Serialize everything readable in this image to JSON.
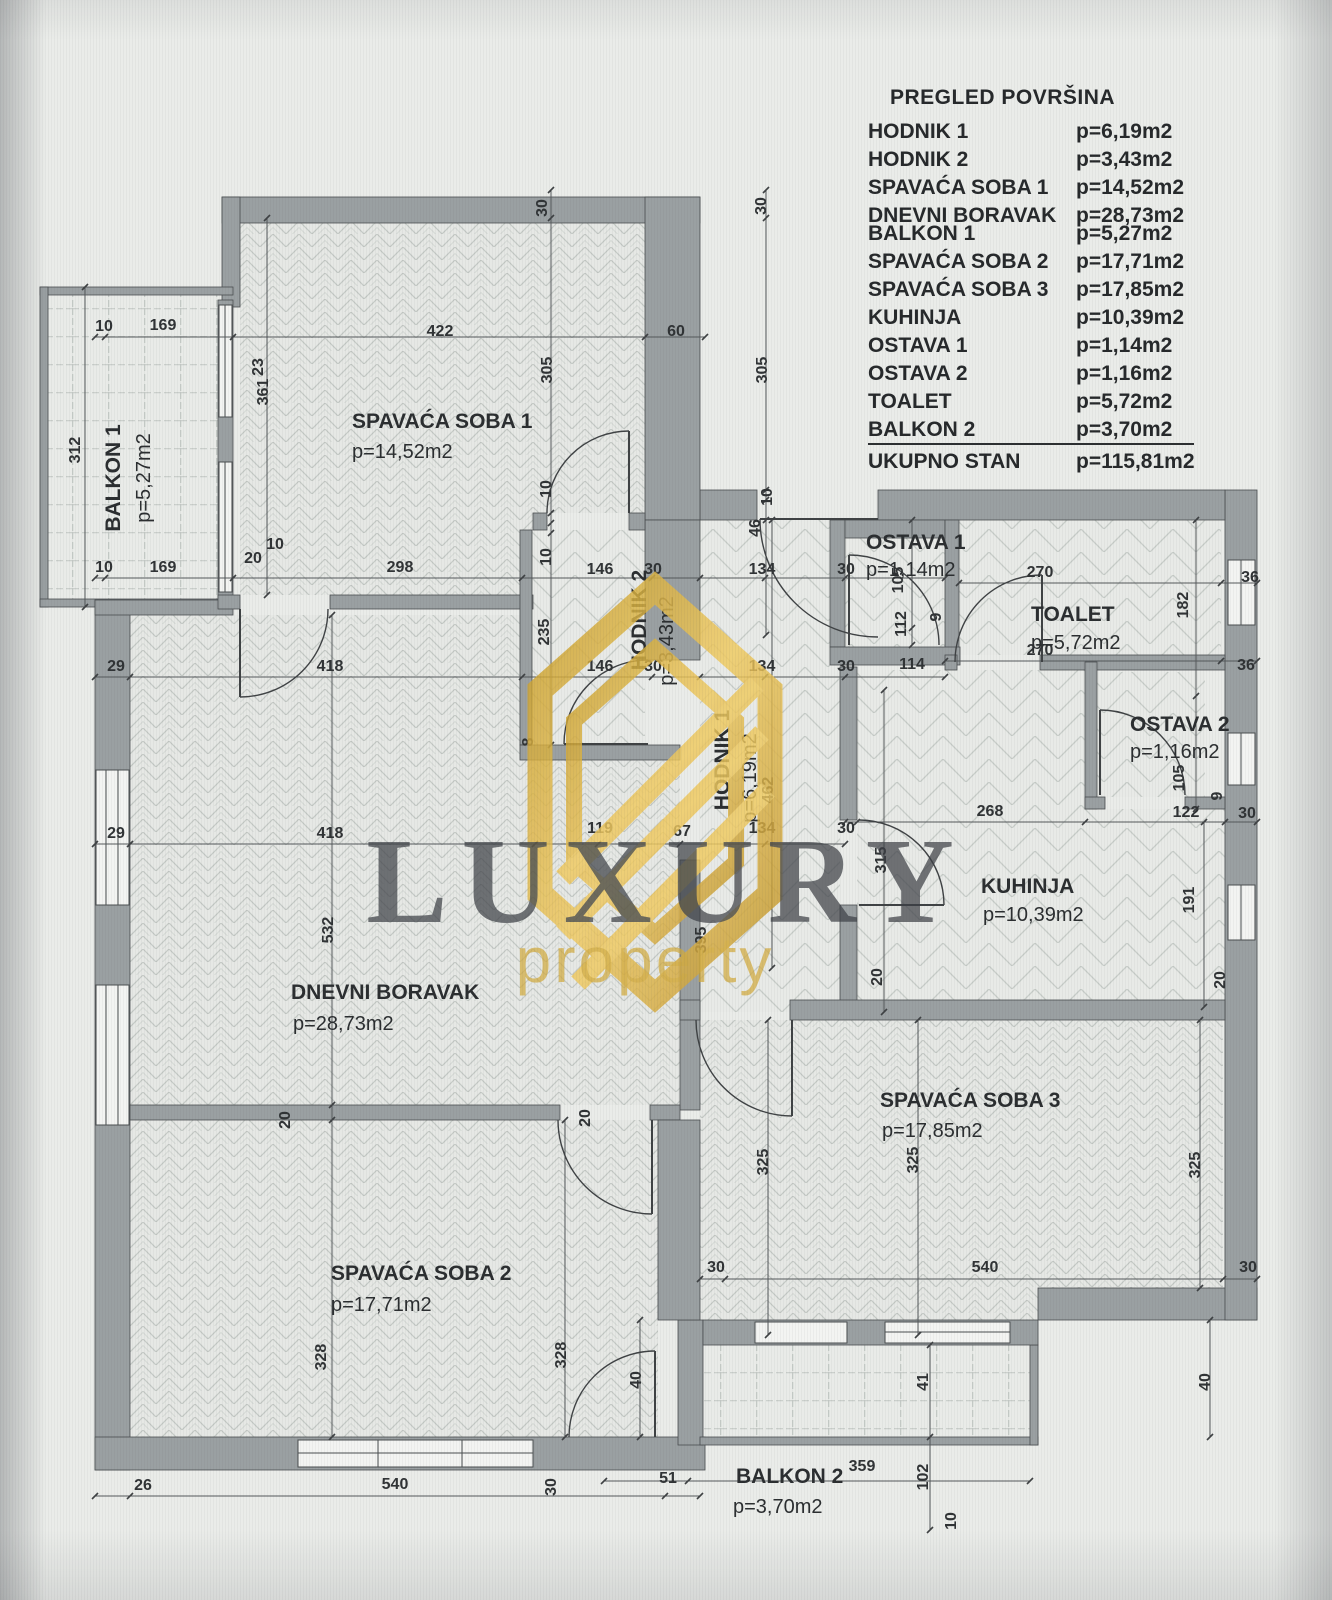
{
  "legend": {
    "title": "PREGLED POVRŠINA",
    "rows": [
      {
        "name": "HODNIK 1",
        "area": "p=6,19m2"
      },
      {
        "name": "HODNIK 2",
        "area": "p=3,43m2"
      },
      {
        "name": "SPAVAĆA SOBA 1",
        "area": "p=14,52m2"
      },
      {
        "name": "DNEVNI BORAVAK",
        "area": "p=28,73m2"
      },
      {
        "name": "BALKON 1",
        "area": "p=5,27m2",
        "tight": true
      },
      {
        "name": "SPAVAĆA SOBA 2",
        "area": "p=17,71m2"
      },
      {
        "name": "SPAVAĆA SOBA 3",
        "area": "p=17,85m2"
      },
      {
        "name": "KUHINJA",
        "area": "p=10,39m2"
      },
      {
        "name": "OSTAVA 1",
        "area": "p=1,14m2"
      },
      {
        "name": "OSTAVA 2",
        "area": "p=1,16m2"
      },
      {
        "name": "TOALET",
        "area": "p=5,72m2"
      },
      {
        "name": "BALKON 2",
        "area": "p=3,70m2",
        "underline": true
      },
      {
        "name": "UKUPNO STAN",
        "area": "p=115,81m2"
      }
    ]
  },
  "rooms": [
    {
      "name": "BALKON 1",
      "area": "p=5,27m2"
    },
    {
      "name": "SPAVAĆA SOBA 1",
      "area": "p=14,52m2"
    },
    {
      "name": "HODNIK 2",
      "area": "p=3,43m2"
    },
    {
      "name": "HODNIK 1",
      "area": "p=6,19m2"
    },
    {
      "name": "OSTAVA 1",
      "area": "p=1,14m2"
    },
    {
      "name": "TOALET",
      "area": "p=5,72m2"
    },
    {
      "name": "OSTAVA 2",
      "area": "p=1,16m2"
    },
    {
      "name": "KUHINJA",
      "area": "p=10,39m2"
    },
    {
      "name": "DNEVNI BORAVAK",
      "area": "p=28,73m2"
    },
    {
      "name": "SPAVAĆA SOBA 3",
      "area": "p=17,85m2"
    },
    {
      "name": "SPAVAĆA SOBA 2",
      "area": "p=17,71m2"
    },
    {
      "name": "BALKON 2",
      "area": "p=3,70m2"
    }
  ],
  "watermark": {
    "title": "LUXURY",
    "subtitle": "property"
  },
  "colors": {
    "wall": "#9aa0a2",
    "gold": "#dcae39",
    "ink": "#303335"
  },
  "dimensions": [
    {
      "v": "10",
      "x": 104,
      "y": 331
    },
    {
      "v": "169",
      "x": 163,
      "y": 330
    },
    {
      "v": "422",
      "x": 440,
      "y": 336
    },
    {
      "v": "60",
      "x": 676,
      "y": 336
    },
    {
      "v": "10",
      "x": 104,
      "y": 572
    },
    {
      "v": "169",
      "x": 163,
      "y": 572
    },
    {
      "v": "298",
      "x": 400,
      "y": 572
    },
    {
      "v": "146",
      "x": 600,
      "y": 574
    },
    {
      "v": "30",
      "x": 653,
      "y": 574
    },
    {
      "v": "134",
      "x": 762,
      "y": 574
    },
    {
      "v": "30",
      "x": 846,
      "y": 574
    },
    {
      "v": "270",
      "x": 1040,
      "y": 577
    },
    {
      "v": "36",
      "x": 1250,
      "y": 582
    },
    {
      "v": "29",
      "x": 116,
      "y": 671
    },
    {
      "v": "418",
      "x": 330,
      "y": 671
    },
    {
      "v": "146",
      "x": 600,
      "y": 671
    },
    {
      "v": "30",
      "x": 653,
      "y": 671
    },
    {
      "v": "134",
      "x": 762,
      "y": 671
    },
    {
      "v": "30",
      "x": 846,
      "y": 671
    },
    {
      "v": "114",
      "x": 912,
      "y": 669
    },
    {
      "v": "270",
      "x": 1040,
      "y": 655
    },
    {
      "v": "36",
      "x": 1246,
      "y": 670
    },
    {
      "v": "29",
      "x": 116,
      "y": 838
    },
    {
      "v": "418",
      "x": 330,
      "y": 838
    },
    {
      "v": "119",
      "x": 600,
      "y": 833
    },
    {
      "v": "67",
      "x": 682,
      "y": 836
    },
    {
      "v": "134",
      "x": 762,
      "y": 833
    },
    {
      "v": "30",
      "x": 846,
      "y": 833
    },
    {
      "v": "268",
      "x": 990,
      "y": 816
    },
    {
      "v": "122",
      "x": 1186,
      "y": 817
    },
    {
      "v": "30",
      "x": 1247,
      "y": 818
    },
    {
      "v": "30",
      "x": 716,
      "y": 1272
    },
    {
      "v": "540",
      "x": 985,
      "y": 1272
    },
    {
      "v": "30",
      "x": 1248,
      "y": 1272
    },
    {
      "v": "26",
      "x": 143,
      "y": 1490
    },
    {
      "v": "540",
      "x": 395,
      "y": 1489
    },
    {
      "v": "51",
      "x": 668,
      "y": 1483
    },
    {
      "v": "359",
      "x": 862,
      "y": 1471
    },
    {
      "v": "20",
      "x": 253,
      "y": 563
    },
    {
      "v": "10",
      "x": 275,
      "y": 549
    },
    {
      "v": "312",
      "x": 80,
      "y": 450,
      "r": -90
    },
    {
      "v": "23",
      "x": 263,
      "y": 367,
      "r": -90
    },
    {
      "v": "361",
      "x": 268,
      "y": 392,
      "r": -90
    },
    {
      "v": "30",
      "x": 547,
      "y": 208,
      "r": -90
    },
    {
      "v": "305",
      "x": 552,
      "y": 370,
      "r": -90
    },
    {
      "v": "10",
      "x": 551,
      "y": 489,
      "r": -90
    },
    {
      "v": "10",
      "x": 551,
      "y": 557,
      "r": -90
    },
    {
      "v": "235",
      "x": 549,
      "y": 632,
      "r": -90
    },
    {
      "v": "30",
      "x": 766,
      "y": 206,
      "r": -90
    },
    {
      "v": "305",
      "x": 767,
      "y": 370,
      "r": -90
    },
    {
      "v": "10",
      "x": 772,
      "y": 497,
      "r": -90
    },
    {
      "v": "46",
      "x": 760,
      "y": 528,
      "r": -90
    },
    {
      "v": "462",
      "x": 773,
      "y": 790,
      "r": -90
    },
    {
      "v": "395",
      "x": 706,
      "y": 940,
      "r": -90
    },
    {
      "v": "8",
      "x": 533,
      "y": 742,
      "r": -90
    },
    {
      "v": "532",
      "x": 333,
      "y": 930,
      "r": -90
    },
    {
      "v": "328",
      "x": 326,
      "y": 1357,
      "r": -90
    },
    {
      "v": "328",
      "x": 566,
      "y": 1355,
      "r": -90
    },
    {
      "v": "20",
      "x": 290,
      "y": 1120,
      "r": -90
    },
    {
      "v": "20",
      "x": 590,
      "y": 1118,
      "r": -90
    },
    {
      "v": "105",
      "x": 903,
      "y": 580,
      "r": -90
    },
    {
      "v": "112",
      "x": 906,
      "y": 624,
      "r": -90
    },
    {
      "v": "9",
      "x": 941,
      "y": 617,
      "r": -90
    },
    {
      "v": "182",
      "x": 1188,
      "y": 605,
      "r": -90
    },
    {
      "v": "105",
      "x": 1184,
      "y": 778,
      "r": -90
    },
    {
      "v": "9",
      "x": 1222,
      "y": 796,
      "r": -90
    },
    {
      "v": "191",
      "x": 1194,
      "y": 900,
      "r": -90
    },
    {
      "v": "315",
      "x": 886,
      "y": 860,
      "r": -90
    },
    {
      "v": "20",
      "x": 882,
      "y": 977,
      "r": -90
    },
    {
      "v": "20",
      "x": 1225,
      "y": 980,
      "r": -90
    },
    {
      "v": "325",
      "x": 768,
      "y": 1162,
      "r": -90
    },
    {
      "v": "325",
      "x": 918,
      "y": 1160,
      "r": -90
    },
    {
      "v": "325",
      "x": 1200,
      "y": 1165,
      "r": -90
    },
    {
      "v": "40",
      "x": 641,
      "y": 1380,
      "r": -90
    },
    {
      "v": "41",
      "x": 928,
      "y": 1382,
      "r": -90
    },
    {
      "v": "40",
      "x": 1210,
      "y": 1382,
      "r": -90
    },
    {
      "v": "102",
      "x": 928,
      "y": 1477,
      "r": -90
    },
    {
      "v": "10",
      "x": 956,
      "y": 1521,
      "r": -90
    },
    {
      "v": "30",
      "x": 556,
      "y": 1487,
      "r": -90
    }
  ]
}
